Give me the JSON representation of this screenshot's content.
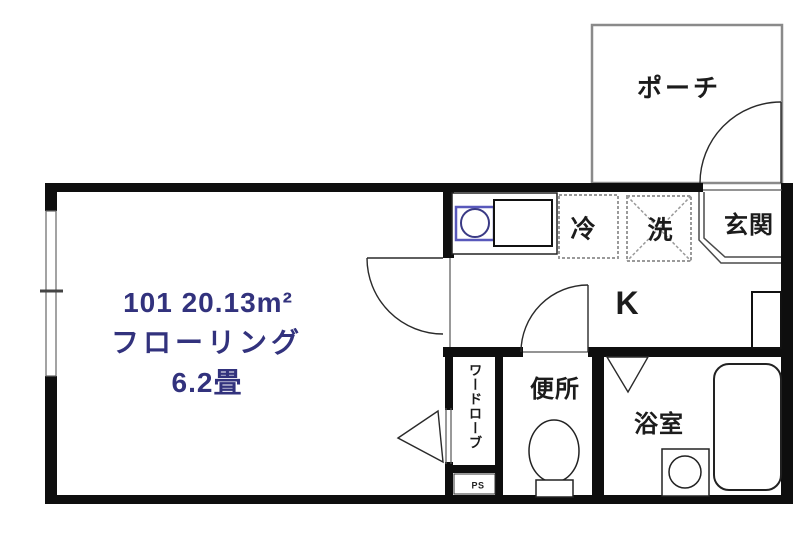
{
  "rooms": {
    "main": {
      "line1": "101  20.13m²",
      "line2": "フローリング",
      "line3": "6.2畳"
    },
    "kitchen": {
      "label": "K"
    },
    "porch": {
      "label": "ポーチ"
    },
    "entrance": {
      "label": "玄関"
    },
    "refrigerator": {
      "label": "冷"
    },
    "washing_machine": {
      "label": "洗"
    },
    "toilet": {
      "label": "便所"
    },
    "bathroom": {
      "label": "浴室"
    },
    "wardrobe": {
      "label": "ワードローブ"
    },
    "pipe_space": {
      "label": "PS"
    }
  },
  "colors": {
    "wall": "#0e0e0e",
    "room_text": "#32327d",
    "label_text": "#1c1c1c",
    "fixture_blue": "#5858bb",
    "sink_circle_blue": "#3a3a85",
    "porch_border": "#8a8a8a",
    "dashed_box_border": "#9a9a9a"
  }
}
